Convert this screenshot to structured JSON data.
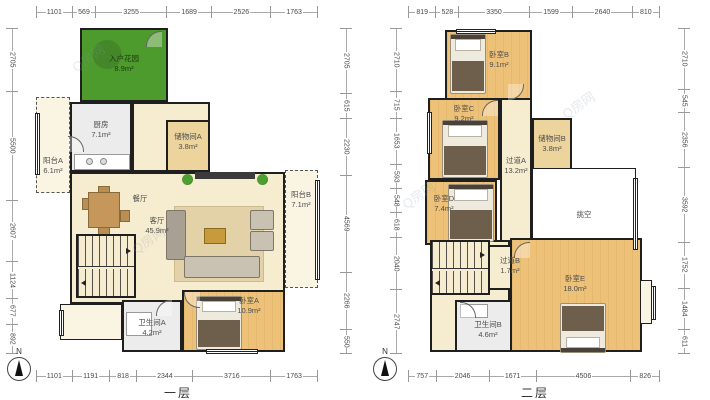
{
  "watermark": "Q房网",
  "compass": {
    "label": "N"
  },
  "colors": {
    "wall": "#1f1f1f",
    "cream": "#f6ecd0",
    "bedroom": "#eec178",
    "storage": "#ecd49c",
    "gray_room": "#ececec",
    "garden_green": "#4d9a2d",
    "dim_text": "#4a4a4a"
  },
  "floor1": {
    "title": "一层",
    "dims": {
      "top": [
        1101,
        569,
        3255,
        1689,
        2526,
        1763
      ],
      "bottom": [
        1101,
        1191,
        818,
        2344,
        3716,
        1763
      ],
      "left": [
        2705,
        5500,
        2607,
        1124,
        677,
        892
      ],
      "right": [
        2705,
        615,
        2230,
        4569,
        2266,
        550
      ]
    },
    "rooms": {
      "entry_garden": {
        "name": "入户花园",
        "area": "8.9m²"
      },
      "kitchen": {
        "name": "厨房",
        "area": "7.1m²"
      },
      "storage_a": {
        "name": "储物间A",
        "area": "3.8m²"
      },
      "balcony_a": {
        "name": "阳台A",
        "area": "6.1m²"
      },
      "dining": {
        "name": "餐厅",
        "area": ""
      },
      "living": {
        "name": "客厅",
        "area": "45.9m²"
      },
      "balcony_b": {
        "name": "阳台B",
        "area": "7.1m²"
      },
      "bedroom_a": {
        "name": "卧室A",
        "area": "10.9m²"
      },
      "bath_a": {
        "name": "卫生间A",
        "area": "4.2m²"
      }
    }
  },
  "floor2": {
    "title": "二层",
    "dims": {
      "top": [
        819,
        528,
        3350,
        1599,
        2640,
        810
      ],
      "bottom": [
        757,
        2046,
        1671,
        4506,
        826
      ],
      "left": [
        2710,
        715,
        1653,
        593,
        548,
        618,
        2040,
        2747
      ],
      "right": [
        2710,
        545,
        2356,
        3592,
        1752,
        1484,
        611
      ]
    },
    "rooms": {
      "bedroom_b": {
        "name": "卧室B",
        "area": "9.1m²"
      },
      "bedroom_c": {
        "name": "卧室C",
        "area": "9.2m²"
      },
      "storage_b": {
        "name": "储物间B",
        "area": "3.8m²"
      },
      "corridor_a": {
        "name": "过道A",
        "area": "13.2m²"
      },
      "bedroom_d": {
        "name": "卧室D",
        "area": "7.4m²"
      },
      "void": {
        "name": "挑空",
        "area": ""
      },
      "corridor_b": {
        "name": "过道B",
        "area": "1.7m²"
      },
      "bedroom_e": {
        "name": "卧室E",
        "area": "18.0m²"
      },
      "bath_b": {
        "name": "卫生间B",
        "area": "4.6m²"
      }
    }
  }
}
